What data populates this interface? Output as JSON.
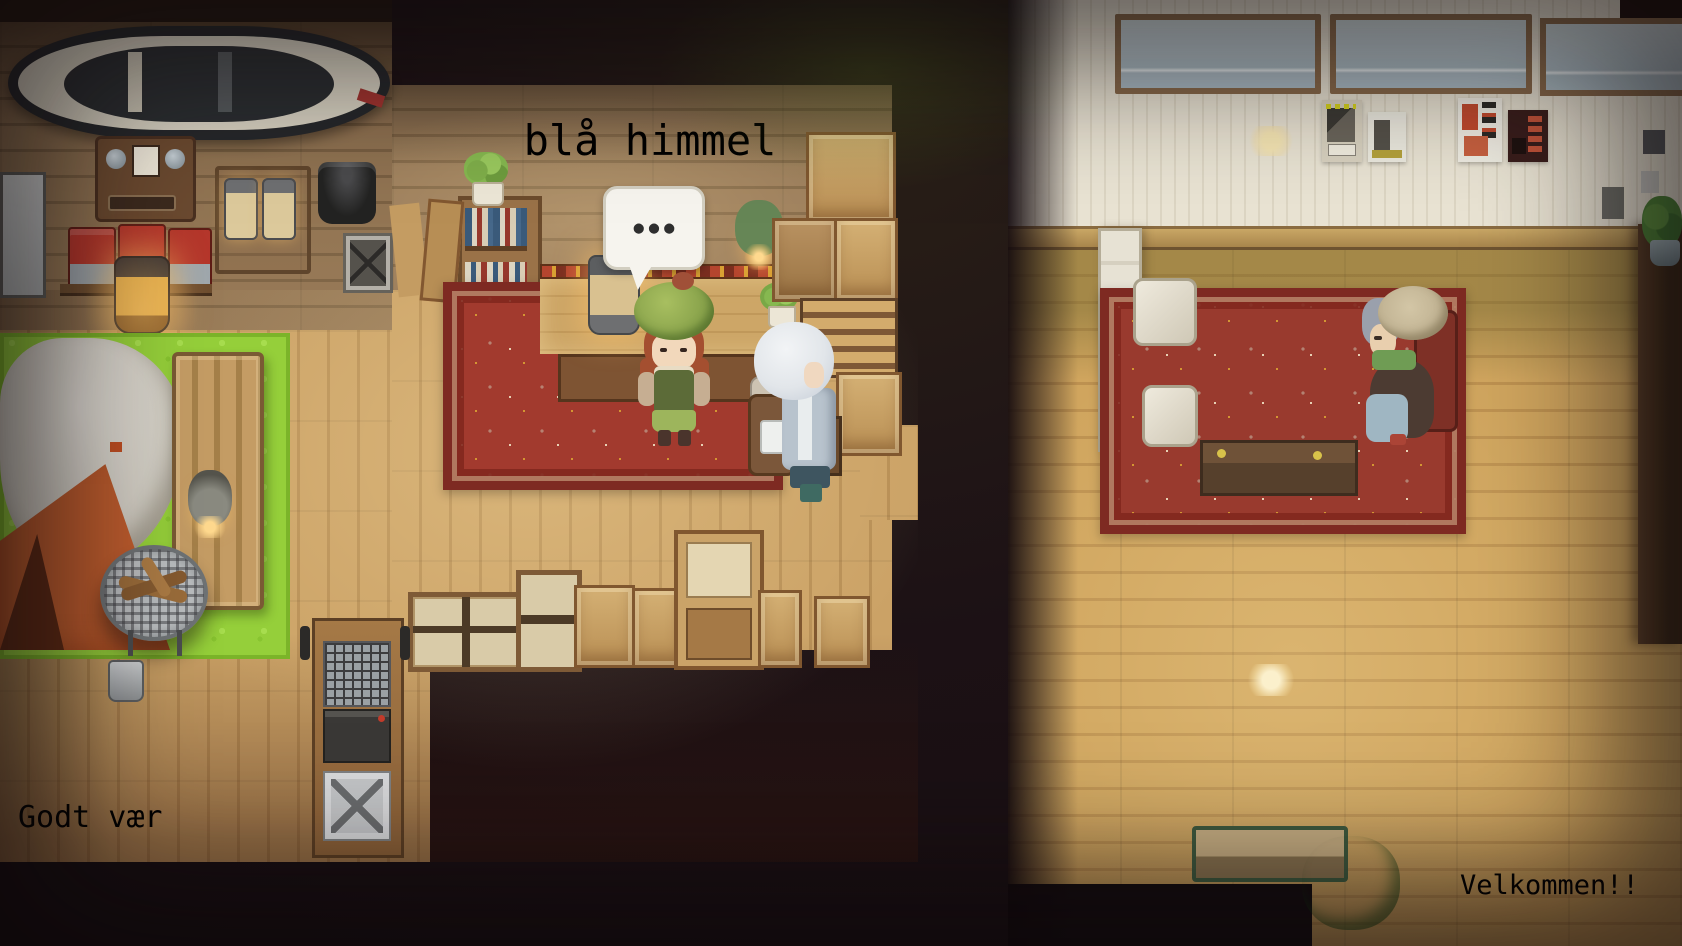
{
  "signs": {
    "shop_name": "blå himmel",
    "floor_left": "Godt vær",
    "floor_right": "Velkommen!!"
  },
  "speech_bubble": {
    "dots": "●●●"
  },
  "characters": {
    "shopkeeper": "girl with green beret behind shop counter",
    "traveler": "white-haired visitor with backpack",
    "elderly_customer": "old lady seated at cafe booth table"
  },
  "palette": {
    "background_dark": "#150d10",
    "wall_wood": "#8d7050",
    "floor_wood_left": "#cba266",
    "floor_wood_right": "#d0a55e",
    "cream_wall": "#e9e3d3",
    "carpet_red": "#a23a2e",
    "grass_green": "#95cf3a",
    "tent_orange": "#bf5d2e",
    "sign_mint": "#cfe7d6",
    "sign_text_green": "#4d9f7d",
    "lamp_teal": "#30505a",
    "lamp_grey": "#a3abac",
    "sign_blue_text": "#d8e7ea"
  },
  "objects": {
    "left_shop": [
      "canoe on wall",
      "radio",
      "camp stoves",
      "lantern rack",
      "cooking pot",
      "box fan",
      "bookshelf",
      "shop counter",
      "potted plant",
      "red carpet",
      "display tent",
      "grass mat",
      "wooden bench",
      "fire basket",
      "camera tripod",
      "hanging lanterns",
      "wooden crates",
      "staircase",
      "gear cart",
      "window frames"
    ],
    "right_cafe": [
      "clerestory windows",
      "pendant lamp teal",
      "pendant lamp grey",
      "poster shelves",
      "picture frames",
      "booth table",
      "white booth chairs",
      "red carpet",
      "bar counter",
      "bar chairs",
      "long table",
      "red chairs",
      "green bench",
      "potted shrub"
    ]
  }
}
